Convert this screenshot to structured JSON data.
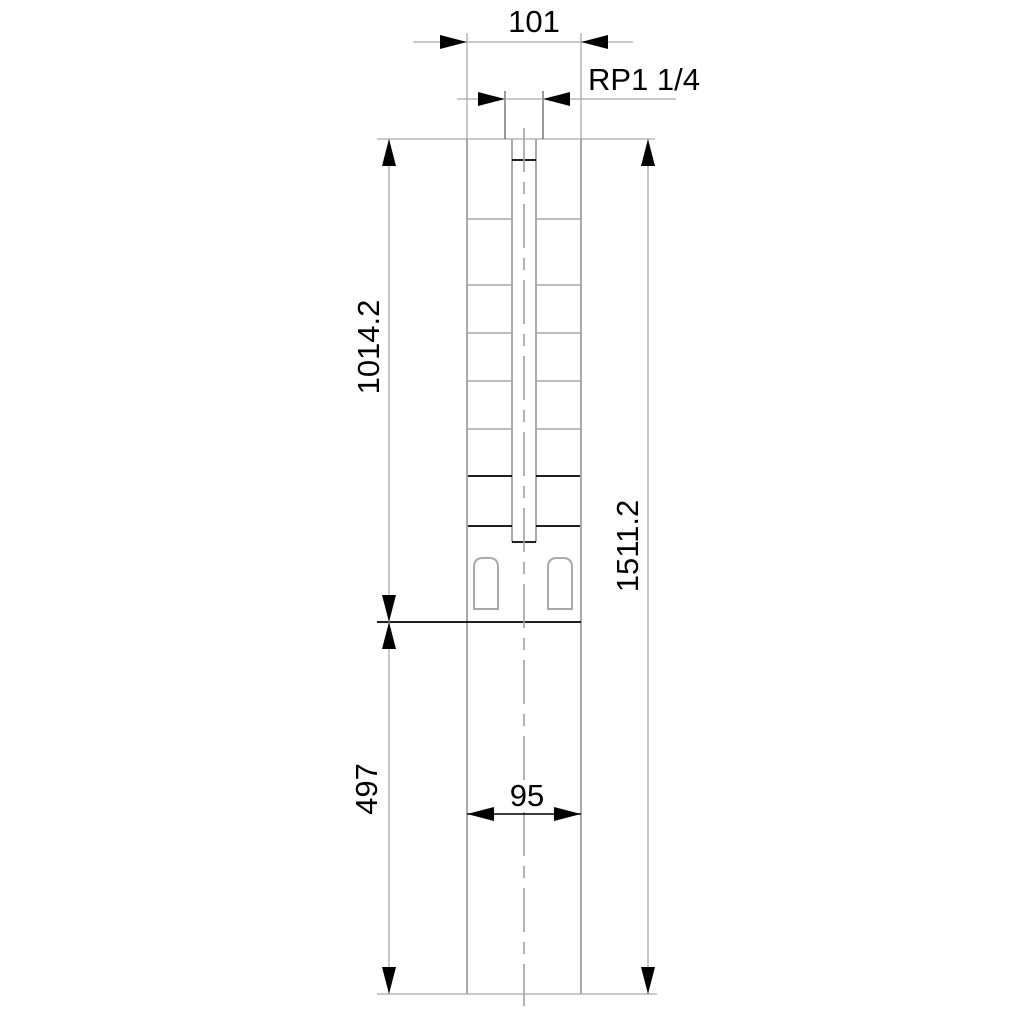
{
  "drawing": {
    "labels": {
      "top_width": "101",
      "thread_size": "RP1 1/4",
      "upper_section_length": "1014.2",
      "total_length": "1511.2",
      "lower_section_length": "497",
      "bottom_width": "95"
    },
    "colors": {
      "background": "#ffffff",
      "outline_gray": "#a9a9a9",
      "feature_black": "#000000",
      "text": "#000000"
    }
  }
}
